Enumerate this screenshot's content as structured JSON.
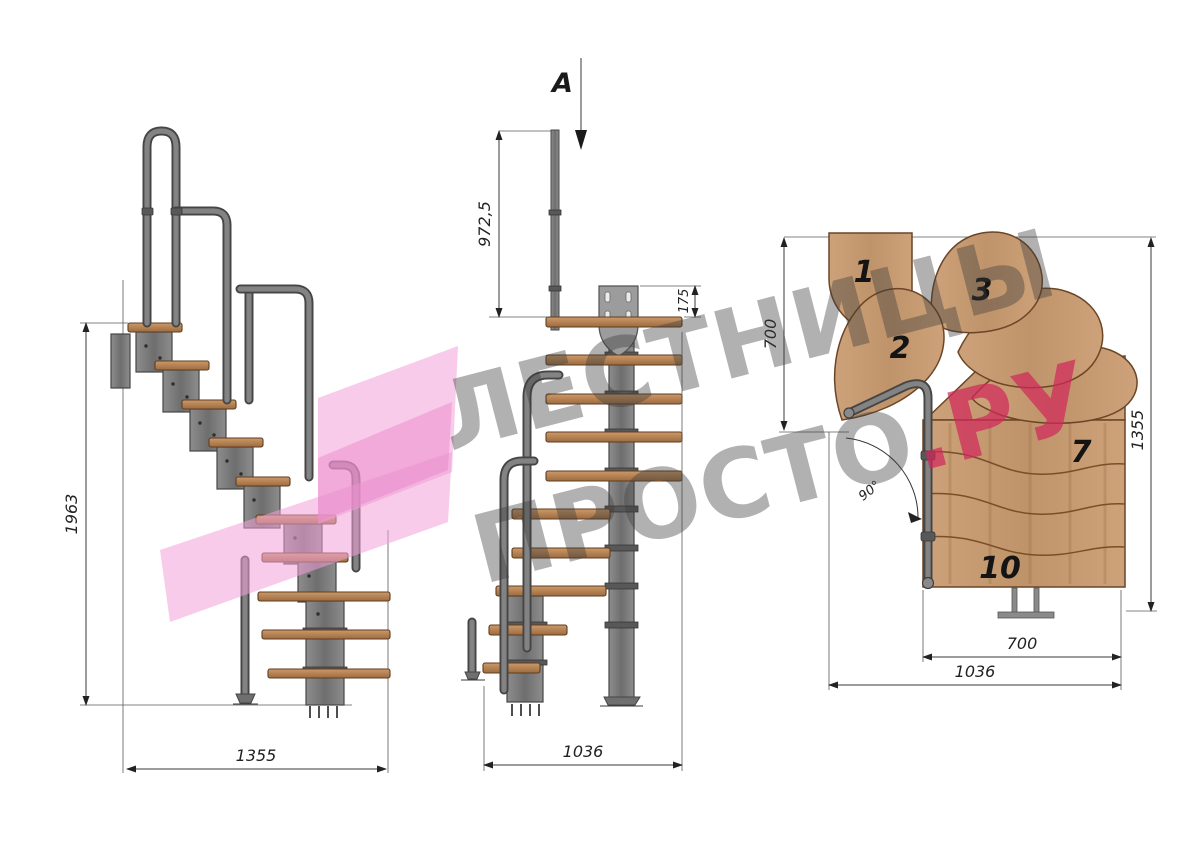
{
  "section_marker": {
    "label": "A"
  },
  "watermark": {
    "line1": "ЛЕСТНИЦЫ",
    "line2_gray": "ПРОСТО",
    "line2_pink": ".РУ",
    "gray_color": "#9c9c9c",
    "pink_color": "#d94f77",
    "logo_pink": "#f6c3e3"
  },
  "views": {
    "side": {
      "dims": {
        "height": "1963",
        "width": "1355"
      }
    },
    "front": {
      "dims": {
        "rail_height": "972,5",
        "bracket_height": "175",
        "width": "1036"
      }
    },
    "plan": {
      "dims": {
        "depth_left": "700",
        "length_right": "1355",
        "width_inner": "700",
        "width_outer": "1036",
        "turn_angle": "90°"
      },
      "steps": [
        "1",
        "2",
        "3",
        "7",
        "10"
      ]
    }
  },
  "colors": {
    "wood": "#c49a6c",
    "metal": "#7b7b7b",
    "dimension_lines": "#3a3a3a"
  }
}
